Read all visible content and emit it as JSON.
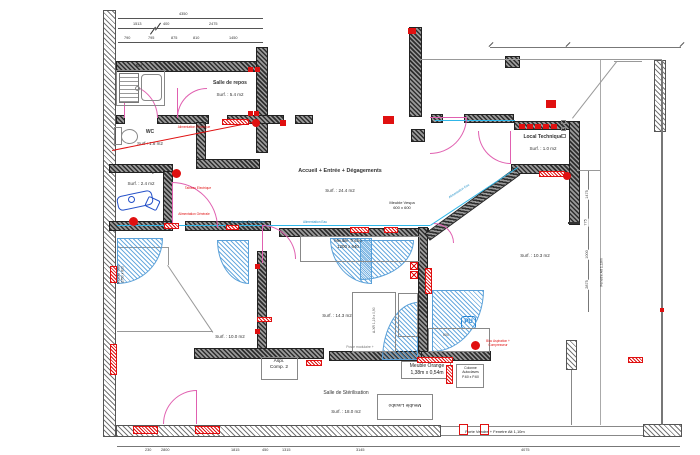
{
  "title": "Plan d'aménagement - cabinet",
  "colors": {
    "wall": "#2e2e2e",
    "door_pink": "#e060b0",
    "marker_red": "#e01010",
    "plumbing_cyan": "#30b6e8",
    "equipment_blue": "#2450c8"
  },
  "rooms": [
    {
      "name": "Salle de repos",
      "surface": "Surf. : 5.4 m2"
    },
    {
      "name": "WC",
      "surface": "Surf : 1.8 m2"
    },
    {
      "name": "Salle X-Ray",
      "surface": "Surf. : 2.4 m2"
    },
    {
      "name": "Accueil + Entrée + Dégagements",
      "surface": "Surf. : 24.4 m2"
    },
    {
      "name": "Local Technique",
      "surface": "Surf. : 1.0 m2"
    },
    {
      "name": "",
      "surface": "Surf. : 10.3 m2"
    },
    {
      "name": "",
      "surface": "Surf. : 14.3 m2"
    },
    {
      "name": "",
      "surface": "Surf. : 10.0 m2"
    },
    {
      "name": "Salle de Stérilisation",
      "surface": "Surf. : 18.0 m2"
    }
  ],
  "furniture": [
    {
      "lines": [
        "Meuble Vespa",
        "600 x 600"
      ],
      "x": 378,
      "y": 200,
      "w": 48,
      "fs": 4
    },
    {
      "lines": [
        "Meuble Tricho",
        "1200 x 640"
      ],
      "x": 322,
      "y": 238,
      "w": 52,
      "fs": 4.4
    },
    {
      "lines": [
        "Meuble Orange",
        "1,38m x 0,54m"
      ],
      "x": 401,
      "y": 363,
      "w": 52,
      "fs": 5
    },
    {
      "lines": [
        "Colonne",
        "Autoclaves",
        "P.60 x P.60"
      ],
      "x": 457,
      "y": 366,
      "w": 27,
      "fs": 3.4
    },
    {
      "lines": [
        "Aspi.",
        "Comp. 2"
      ],
      "x": 262,
      "y": 359,
      "w": 34,
      "fs": 4.8
    },
    {
      "lines": [
        "Meuble Lavabo"
      ],
      "x": 378,
      "y": 401,
      "w": 54,
      "fs": 4.8,
      "rot": 180
    },
    {
      "lines": [
        "Meuble Tisio",
        "2750 x 600"
      ],
      "x": 100,
      "y": 270,
      "w": 42,
      "fs": 3.4,
      "rot": -90
    },
    {
      "lines": [
        "Bar"
      ],
      "x": 131,
      "y": 63,
      "w": 16,
      "fs": 4.2
    },
    {
      "lines": [
        "Porte Vendre + Fenetre Alt 1,10m"
      ],
      "x": 428,
      "y": 429,
      "w": 134,
      "fs": 4
    },
    {
      "lines": [
        "Fenetre Alt 1,10m"
      ],
      "x": 578,
      "y": 270,
      "w": 48,
      "fs": 3.6,
      "rot": -90
    },
    {
      "lines": [
        "Poste modulaire +"
      ],
      "x": 332,
      "y": 345,
      "w": 56,
      "fs": 3.4,
      "col": "#777"
    },
    {
      "lines": [
        "A-XR 1,19 x 0,90"
      ],
      "x": 346,
      "y": 318,
      "w": 56,
      "fs": 3.4,
      "col": "#555",
      "rot": -90
    },
    {
      "lines": [
        "600"
      ],
      "x": 438,
      "y": 333,
      "w": 16,
      "fs": 3.6,
      "col": "#555"
    }
  ],
  "pu_icon_label": "PU",
  "notes_red": [
    {
      "t": "Alimentation Electrique",
      "x": 172,
      "y": 125,
      "w": 44
    },
    {
      "t": "Tableau Electrique",
      "x": 178,
      "y": 186,
      "w": 40
    },
    {
      "t": "Alimentation Générale",
      "x": 172,
      "y": 212,
      "w": 44
    },
    {
      "t": "Bloc Aspiration + Compresseur",
      "x": 477,
      "y": 339,
      "w": 42
    }
  ],
  "notes_blue": [
    {
      "t": "Evacuation Eaux Usées",
      "x": 224,
      "y": 220,
      "w": 48
    },
    {
      "t": "Alimentation Eau",
      "x": 296,
      "y": 220,
      "w": 38
    },
    {
      "t": "Alimentation Eau",
      "x": 440,
      "y": 189,
      "w": 38,
      "rot": -33
    }
  ],
  "dimensions": {
    "top_rows": [
      {
        "y": 18,
        "x1": 118,
        "x2": 263,
        "labels": [
          {
            "t": "4350",
            "x": 178
          }
        ]
      },
      {
        "y": 28,
        "x1": 118,
        "x2": 263,
        "labels": [
          {
            "t": "1513",
            "x": 132
          },
          {
            "t": "400",
            "x": 162
          },
          {
            "t": "2475",
            "x": 208
          }
        ]
      },
      {
        "y": 42,
        "x1": 118,
        "x2": 263,
        "labels": [
          {
            "t": "790",
            "x": 123
          },
          {
            "t": "795",
            "x": 147
          },
          {
            "t": "875",
            "x": 170
          },
          {
            "t": "810",
            "x": 192
          },
          {
            "t": "1450",
            "x": 228
          }
        ]
      }
    ],
    "bottom": {
      "y": 446,
      "x1": 117,
      "x2": 680,
      "labels": [
        {
          "t": "230",
          "x": 144
        },
        {
          "t": "2800",
          "x": 160
        },
        {
          "t": "1815",
          "x": 230
        },
        {
          "t": "450",
          "x": 261
        },
        {
          "t": "1315",
          "x": 281
        },
        {
          "t": "3145",
          "x": 355
        },
        {
          "t": "4075",
          "x": 520
        }
      ]
    },
    "right": {
      "x": 588,
      "y1": 170,
      "y2": 312,
      "labels": [
        {
          "t": "1475",
          "y": 192
        },
        {
          "t": "775",
          "y": 220
        },
        {
          "t": "1000",
          "y": 252
        },
        {
          "t": "2875",
          "y": 282
        }
      ]
    },
    "top_right_line": {
      "y": 47,
      "x1": 490,
      "x2": 681
    }
  }
}
